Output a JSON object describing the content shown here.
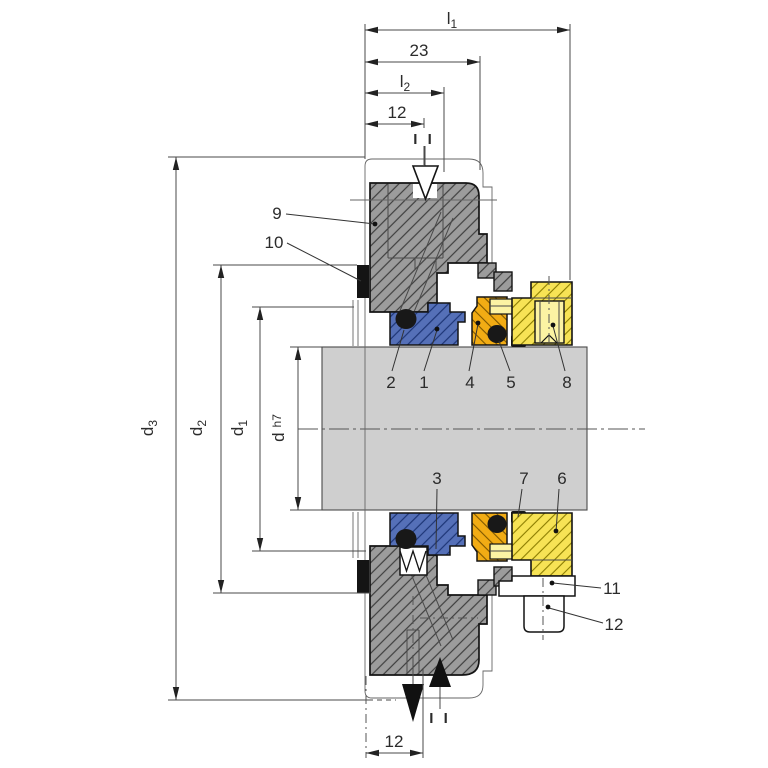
{
  "drawing": {
    "type": "mechanical-seal-cross-section",
    "dims_top": {
      "l1": {
        "base": "l",
        "sub": "1"
      },
      "w23": "23",
      "l2": {
        "base": "l",
        "sub": "2"
      },
      "w12": "12"
    },
    "dims_left": {
      "d3": {
        "base": "d",
        "sub": "3"
      },
      "d2": {
        "base": "d",
        "sub": "2"
      },
      "d1": {
        "base": "d",
        "sub": "1"
      },
      "dh7": {
        "base": "d",
        "tol": "h7"
      }
    },
    "dims_bottom": {
      "w12": "12"
    },
    "section_marks": {
      "top": "I I",
      "bottom": "I I"
    },
    "callouts": {
      "c1": "1",
      "c2": "2",
      "c3": "3",
      "c4": "4",
      "c5": "5",
      "c6": "6",
      "c7": "7",
      "c8": "8",
      "c9": "9",
      "c10": "10",
      "c11": "11",
      "c12": "12"
    },
    "colors": {
      "shaft_gray": "#cfcfcf",
      "housing_gray": "#9c9c9c",
      "seal_face_blue": "#5570b8",
      "mating_ring_orange": "#f2ac14",
      "collar_yellow": "#f7e355",
      "insert_light_yellow": "#fcf3a3",
      "elastomer_black": "#181818"
    }
  }
}
